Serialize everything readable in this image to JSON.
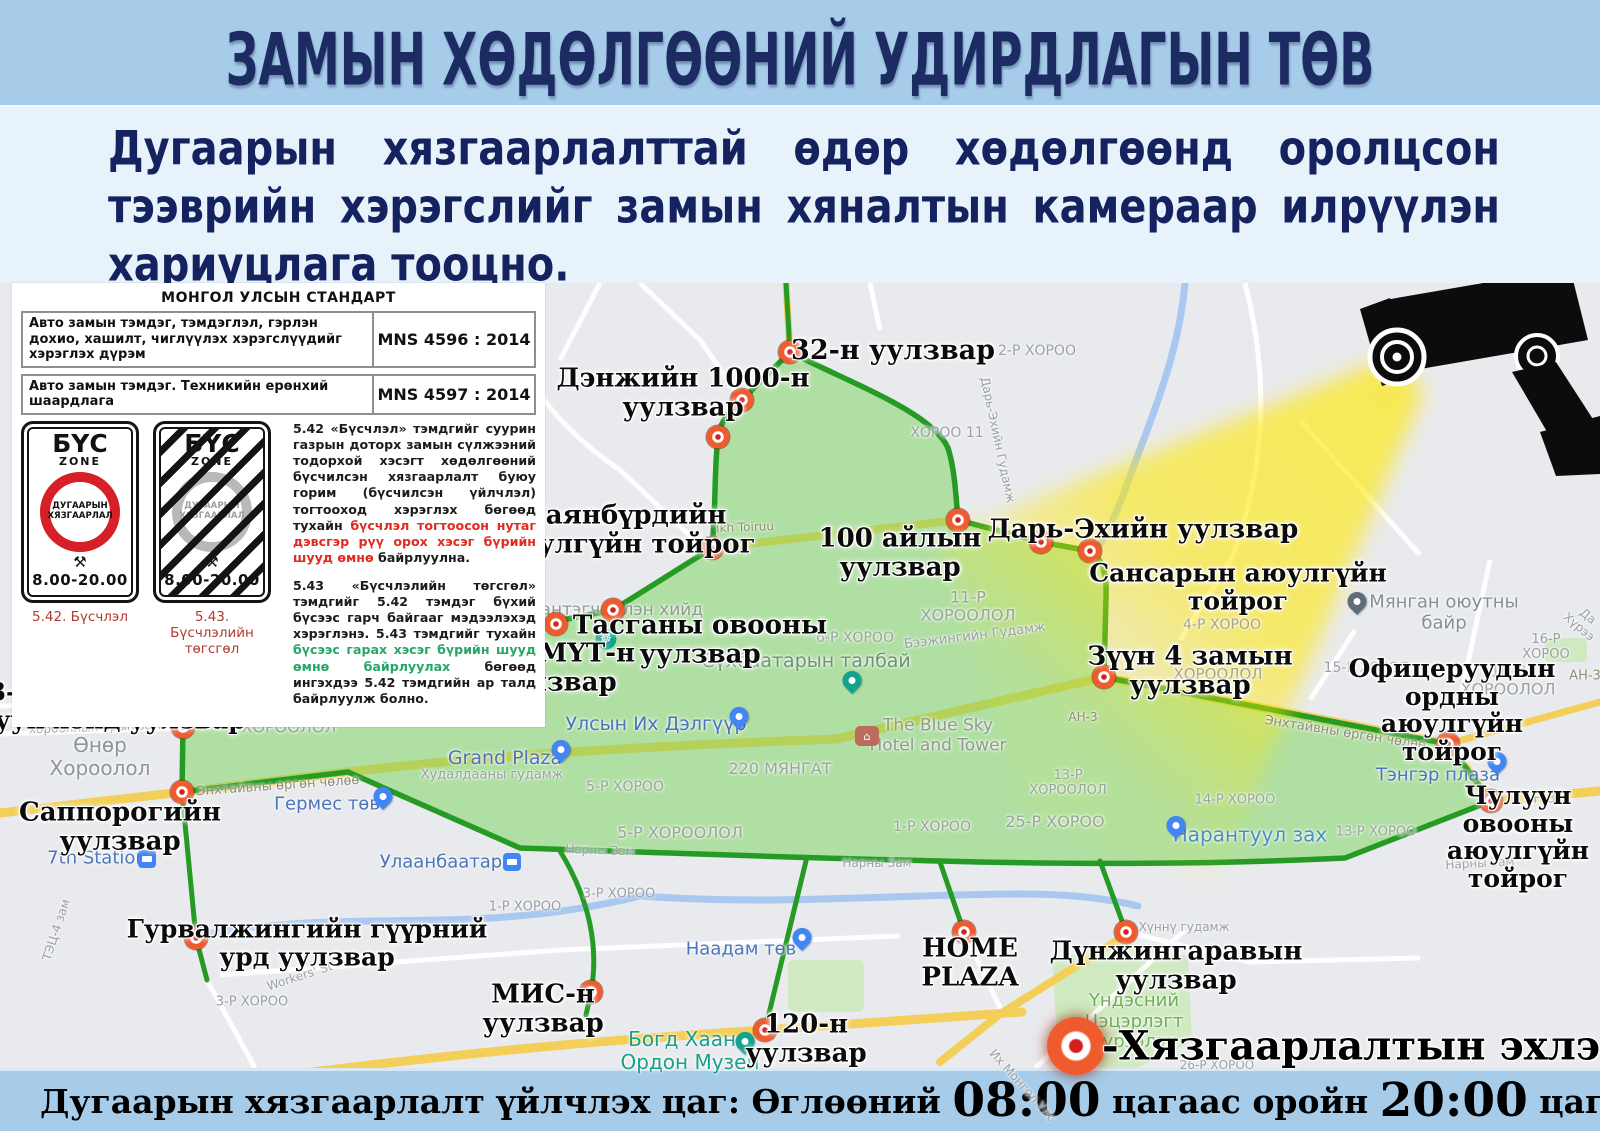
{
  "header": {
    "title": "ЗАМЫН ХӨДӨЛГӨӨНИЙ УДИРДЛАГЫН ТӨВ"
  },
  "intro": {
    "text": "Дугаарын хязгаарлалттай өдөр хөдөлгөөнд оролцсон тээврийн хэрэгслийг замын хяналтын камераар илрүүлэн хариуцлага тооцно."
  },
  "standards": {
    "title": "МОНГОЛ УЛСЫН СТАНДАРТ",
    "rows": [
      {
        "name": "Авто замын тэмдэг, тэмдэглэл, гэрлэн дохио, хашилт, чиглүүлэх хэрэгслүүдийг хэрэглэх дүрэм",
        "code": "MNS 4596 : 2014"
      },
      {
        "name": "Авто замын тэмдэг. Техникийн ерөнхий шаардлага",
        "code": "MNS 4597 : 2014"
      }
    ]
  },
  "signs": {
    "zone_word": "БҮС",
    "zone_sub": "ZONE",
    "circle_line1": "ДУГААРЫН",
    "circle_line2": "ХЯЗГААРЛАЛ",
    "hammers": "⚒",
    "hours": "8.00-20.00",
    "caption_start": "5.42. Бүсчлэл",
    "caption_end": "5.43. Бүсчлэлийн төгсгөл"
  },
  "rules": {
    "p542": {
      "lead": "5.42 «Бүсчлэл»",
      "body1": " тэмдгийг суурин газрын доторх замын сүлжээний тодорхой хэсэгт хөдөлгөөний бүсчилсэн хязгаарлалт буюу горим (бүсчилсэн үйлчлэл) тогтооход хэрэглэх бөгөөд тухайн ",
      "highlight": "бүсчлэл тогтоосон нутаг дэвсгэр рүү орох хэсэг бүрийн шууд өмнө",
      "body2": " байрлуулна."
    },
    "p543": {
      "lead": "5.43 «Бүсчлэлийн төгсгөл»",
      "body1": " тэмдгийг 5.42 тэмдэг бүхий бүсээс гарч байгааг мэдээлэхэд хэрэглэнэ. 5.43 тэмдгийг тухайн ",
      "highlight": "бүсээс гарах хэсэг бүрийн шууд өмнө байрлуулах",
      "body2": " бөгөөд ингэхдээ 5.42 тэмдгийн ар талд байрлуулж болно."
    }
  },
  "legend": {
    "text": "-Хязгаарлалтын эхлэлийн цэг"
  },
  "footer": {
    "part1": "Дугаарын хязгаарлалт үйлчлэх цаг: Өглөөний ",
    "time1": "08:00",
    "part2": " цагаас оройн ",
    "time2": "20:00",
    "part3": " цаг"
  },
  "colors": {
    "zone_fill": "#77d45a",
    "zone_border": "#259a24",
    "marker_red": "#ef5b2d",
    "beam_yellow": "#ffe800",
    "header_blue": "#a6cce9",
    "title_navy": "#1d2b63"
  },
  "map": {
    "markers": [
      {
        "x": 790,
        "y": 352
      },
      {
        "x": 742,
        "y": 400
      },
      {
        "x": 718,
        "y": 437
      },
      {
        "x": 712,
        "y": 548
      },
      {
        "x": 613,
        "y": 610
      },
      {
        "x": 556,
        "y": 624
      },
      {
        "x": 406,
        "y": 637
      },
      {
        "x": 295,
        "y": 641
      },
      {
        "x": 183,
        "y": 727
      },
      {
        "x": 182,
        "y": 792
      },
      {
        "x": 196,
        "y": 938
      },
      {
        "x": 958,
        "y": 520
      },
      {
        "x": 1041,
        "y": 542
      },
      {
        "x": 1090,
        "y": 551
      },
      {
        "x": 1104,
        "y": 677
      },
      {
        "x": 1448,
        "y": 744
      },
      {
        "x": 1491,
        "y": 801
      },
      {
        "x": 591,
        "y": 992
      },
      {
        "x": 765,
        "y": 1030
      },
      {
        "x": 964,
        "y": 932
      },
      {
        "x": 1126,
        "y": 932
      }
    ],
    "labels": [
      {
        "t": "32-н уулзвар",
        "x": 893,
        "y": 351,
        "s": 27
      },
      {
        "t": "Дэнжийн 1000-н\nуулзвар",
        "x": 683,
        "y": 393,
        "s": 26
      },
      {
        "t": "Баянбүрдийн\nаюулгүйн тойрог",
        "x": 625,
        "y": 530,
        "s": 26
      },
      {
        "t": "100 айлын\nуулзвар",
        "x": 900,
        "y": 553,
        "s": 26
      },
      {
        "t": "Дарь-Эхийн уулзвар",
        "x": 1143,
        "y": 530,
        "s": 26
      },
      {
        "t": "Сансарын аюулгүйн тойрог",
        "x": 1238,
        "y": 587,
        "s": 25
      },
      {
        "t": "Өргөө кино\nтеатрын уулзвар",
        "x": 400,
        "y": 609,
        "s": 26
      },
      {
        "t": "Тасганы овооны\nуулзвар",
        "x": 700,
        "y": 640,
        "s": 26
      },
      {
        "t": "ЭХЭМҮТ-н\nуулзвар",
        "x": 556,
        "y": 668,
        "s": 26
      },
      {
        "t": "3,4-р хорооллын\nэцсийн уулзвар",
        "x": 297,
        "y": 673,
        "s": 26
      },
      {
        "t": "Зүүн 4 замын\nуулзвар",
        "x": 1190,
        "y": 671,
        "s": 26
      },
      {
        "t": "3-р эмнэлгийн\nбаруун хойд уулзвар",
        "x": 95,
        "y": 706,
        "s": 25
      },
      {
        "t": "Офицеруудын ордны\nаюулгүйн тойрог",
        "x": 1452,
        "y": 710,
        "s": 25
      },
      {
        "t": "Саппорогийн\nуулзвар",
        "x": 120,
        "y": 827,
        "s": 26
      },
      {
        "t": "Чулуун овооны\nаюулгүйн тойрог",
        "x": 1518,
        "y": 837,
        "s": 25
      },
      {
        "t": "Гурвалжингийн гүүрний\nурд уулзвар",
        "x": 307,
        "y": 943,
        "s": 25
      },
      {
        "t": "МИС-н\nуулзвар",
        "x": 543,
        "y": 1009,
        "s": 26
      },
      {
        "t": "120-н\nуулзвар",
        "x": 806,
        "y": 1039,
        "s": 26
      },
      {
        "t": "HOME\nPLAZA",
        "x": 970,
        "y": 963,
        "s": 26
      },
      {
        "t": "Дүнжингаравын\nуулзвар",
        "x": 1176,
        "y": 966,
        "s": 26
      }
    ],
    "places": [
      {
        "t": "2-Р ХОРОО",
        "x": 1037,
        "y": 351,
        "s": 14
      },
      {
        "t": "ХОРОО 11",
        "x": 947,
        "y": 433,
        "s": 14
      },
      {
        "t": "11-Р\nХОРООЛОЛ",
        "x": 968,
        "y": 607,
        "s": 16,
        "c": "#98a59b"
      },
      {
        "t": "6-Р ХОРОО",
        "x": 855,
        "y": 638,
        "s": 14,
        "c": "#98a59b"
      },
      {
        "t": "4-Р ХОРОО",
        "x": 1222,
        "y": 625,
        "s": 14,
        "c": "#a8a48c"
      },
      {
        "t": "15-Р\nХОРООЛОЛ",
        "x": 1218,
        "y": 666,
        "s": 15,
        "c": "#a8a48c"
      },
      {
        "t": "15-Р ХОРОО",
        "x": 1367,
        "y": 668,
        "s": 14
      },
      {
        "t": "16-Р ХОРОО",
        "x": 1546,
        "y": 648,
        "s": 13
      },
      {
        "t": "16-Р\nХОРООЛОЛ",
        "x": 1508,
        "y": 681,
        "s": 16
      },
      {
        "t": "Өнөр\nХороолол",
        "x": 100,
        "y": 757,
        "s": 20,
        "c": "#8d949c"
      },
      {
        "t": "3-Р ХОРООЛОЛ",
        "x": 387,
        "y": 604,
        "s": 14
      },
      {
        "t": "4-Р ХОРООЛОЛ",
        "x": 371,
        "y": 669,
        "s": 14,
        "c": "#98a59b"
      },
      {
        "t": "10-Р\nХОРООЛОЛ",
        "x": 289,
        "y": 719,
        "s": 16,
        "c": "#98a59b"
      },
      {
        "t": "5-Р ХОРОО",
        "x": 625,
        "y": 787,
        "s": 14,
        "c": "#98a59b"
      },
      {
        "t": "5-Р ХОРООЛОЛ",
        "x": 680,
        "y": 833,
        "s": 16,
        "c": "#98a59b"
      },
      {
        "t": "1-Р ХОРОО",
        "x": 932,
        "y": 827,
        "s": 14,
        "c": "#98a59b"
      },
      {
        "t": "220 МЯНГАТ",
        "x": 780,
        "y": 769,
        "s": 16,
        "c": "#98a59b"
      },
      {
        "t": "13-Р\nХОРООЛОЛ",
        "x": 1068,
        "y": 784,
        "s": 13,
        "c": "#98a59b"
      },
      {
        "t": "25-Р ХОРОО",
        "x": 1055,
        "y": 822,
        "s": 16,
        "c": "#98a59b"
      },
      {
        "t": "14-Р ХОРОО",
        "x": 1235,
        "y": 801,
        "s": 13,
        "c": "#98a59b"
      },
      {
        "t": "13-Р ХОРОО",
        "x": 1376,
        "y": 833,
        "s": 13,
        "c": "#98a59b"
      },
      {
        "t": "1-Р ХОРОО",
        "x": 525,
        "y": 908,
        "s": 13
      },
      {
        "t": "3-Р ХОРОО",
        "x": 619,
        "y": 895,
        "s": 13
      },
      {
        "t": "26-Р ХОРОО",
        "x": 1217,
        "y": 1066,
        "s": 12
      },
      {
        "t": "3-Р ХОРОО",
        "x": 252,
        "y": 1003,
        "s": 13
      },
      {
        "t": "хорооллын арын зам",
        "x": 95,
        "y": 728,
        "s": 12,
        "r": -2
      },
      {
        "t": "Энхтайвны өргөн чөлөө",
        "x": 278,
        "y": 787,
        "s": 13,
        "r": -4,
        "c": "#8f8d75"
      },
      {
        "t": "Энхтайвны өргөн чөлөө",
        "x": 1345,
        "y": 734,
        "s": 13,
        "r": 9,
        "c": "#8f8d75"
      },
      {
        "t": "Нарны Зам",
        "x": 600,
        "y": 851,
        "s": 12,
        "r": 2
      },
      {
        "t": "Нарны Зам",
        "x": 877,
        "y": 864,
        "s": 12
      },
      {
        "t": "Нарны Зам",
        "x": 1480,
        "y": 864,
        "s": 12,
        "r": -3
      },
      {
        "t": "Бээжингийн Гудамж",
        "x": 975,
        "y": 637,
        "s": 13,
        "r": -7
      },
      {
        "t": "Ард Аюуш Ave",
        "x": 432,
        "y": 633,
        "s": 12,
        "r": -2,
        "c": "#8f8d75"
      },
      {
        "t": "Худалдааны гудамж",
        "x": 245,
        "y": 624,
        "s": 13
      },
      {
        "t": "Худалдааны гудамж",
        "x": 492,
        "y": 776,
        "s": 13
      },
      {
        "t": "Ikh Toiruu",
        "x": 745,
        "y": 528,
        "s": 12,
        "r": -2,
        "c": "#8f8d75"
      },
      {
        "t": "Хүннү гудамж",
        "x": 1184,
        "y": 928,
        "s": 12
      },
      {
        "t": "АН-3",
        "x": 1540,
        "y": 800,
        "s": 13,
        "c": "#8f8d75"
      },
      {
        "t": "АН-3",
        "x": 1083,
        "y": 718,
        "s": 12,
        "c": "#8f8d75"
      },
      {
        "t": "АН-3",
        "x": 1585,
        "y": 677,
        "s": 13,
        "c": "#8f8d75"
      },
      {
        "t": "Их Монгол Улс",
        "x": 1022,
        "y": 1086,
        "s": 12,
        "r": 48
      },
      {
        "t": "Workers' St",
        "x": 300,
        "y": 977,
        "s": 12,
        "r": -18
      },
      {
        "t": "ТЭЦ-4 зам",
        "x": 57,
        "y": 930,
        "s": 12,
        "r": -72
      },
      {
        "t": "Дарь-Эхийн Гудамж",
        "x": 997,
        "y": 440,
        "s": 12,
        "r": 78
      },
      {
        "t": "Да Хүрээ",
        "x": 1583,
        "y": 622,
        "s": 12,
        "r": 40
      },
      {
        "t": "E Mart",
        "x": 278,
        "y": 610,
        "s": 19,
        "c": "#4b74ba"
      },
      {
        "t": "Улсын Их Дэлгүүр",
        "x": 656,
        "y": 725,
        "s": 19,
        "c": "#4b74ba"
      },
      {
        "t": "Grand Plaza",
        "x": 505,
        "y": 759,
        "s": 19,
        "c": "#4b74ba"
      },
      {
        "t": "Гермес төв",
        "x": 327,
        "y": 805,
        "s": 18,
        "c": "#4b74ba"
      },
      {
        "t": "Тэнгэр плаза",
        "x": 1438,
        "y": 776,
        "s": 18,
        "c": "#4b74ba"
      },
      {
        "t": "Наадам төв",
        "x": 741,
        "y": 950,
        "s": 18,
        "c": "#4b74ba"
      },
      {
        "t": "Улаанбаатар",
        "x": 441,
        "y": 863,
        "s": 18,
        "c": "#4b74ba"
      },
      {
        "t": "7th Station",
        "x": 97,
        "y": 859,
        "s": 18,
        "c": "#4b74ba"
      },
      {
        "t": "Нарантуул зах",
        "x": 1250,
        "y": 835,
        "s": 20,
        "c": "#4b90ba"
      },
      {
        "t": "Сүхбаатарын талбай",
        "x": 806,
        "y": 662,
        "s": 19,
        "c": "#6a9377"
      },
      {
        "t": "Богд Хааны\nОрдон Музей",
        "x": 690,
        "y": 1051,
        "s": 20,
        "c": "#19a08c"
      },
      {
        "t": "Гандантэгчинлэн хийд",
        "x": 600,
        "y": 611,
        "s": 17,
        "c": "#8e9a90"
      },
      {
        "t": "Мянган оюутны байр",
        "x": 1444,
        "y": 613,
        "s": 18,
        "c": "#868e96"
      },
      {
        "t": "Үндэсний\nЦэцэрлэгт\nХүрээлэн",
        "x": 1134,
        "y": 1022,
        "s": 18,
        "c": "#6fae53"
      },
      {
        "t": "The Blue Sky\nHotel and Tower",
        "x": 938,
        "y": 736,
        "s": 17,
        "c": "#8e9a90"
      }
    ],
    "pins": [
      {
        "x": 312,
        "y": 606,
        "type": "drop",
        "c": "#4285f4"
      },
      {
        "x": 739,
        "y": 726,
        "type": "drop",
        "c": "#4285f4"
      },
      {
        "x": 561,
        "y": 759,
        "type": "drop",
        "c": "#4285f4"
      },
      {
        "x": 383,
        "y": 806,
        "type": "drop",
        "c": "#4285f4"
      },
      {
        "x": 1497,
        "y": 771,
        "type": "drop",
        "c": "#4285f4"
      },
      {
        "x": 802,
        "y": 947,
        "type": "drop",
        "c": "#4285f4"
      },
      {
        "x": 1176,
        "y": 835,
        "type": "drop",
        "c": "#4285f4"
      },
      {
        "x": 852,
        "y": 690,
        "type": "drop",
        "c": "#12a38e"
      },
      {
        "x": 745,
        "y": 1051,
        "type": "drop",
        "c": "#12a38e"
      },
      {
        "x": 1357,
        "y": 611,
        "type": "drop",
        "c": "#5f6d7a"
      },
      {
        "x": 240,
        "y": 658,
        "type": "drop",
        "c": "#d07b4f",
        "g": "H"
      },
      {
        "x": 512,
        "y": 862,
        "type": "square",
        "c": "#4285f4"
      },
      {
        "x": 147,
        "y": 859,
        "type": "square",
        "c": "#4285f4"
      },
      {
        "x": 606,
        "y": 639,
        "type": "wheel",
        "c": "#12a38e",
        "g": "☸"
      },
      {
        "x": 867,
        "y": 736,
        "type": "hotel",
        "c": "#bc6b5c",
        "g": "⌂"
      }
    ]
  }
}
